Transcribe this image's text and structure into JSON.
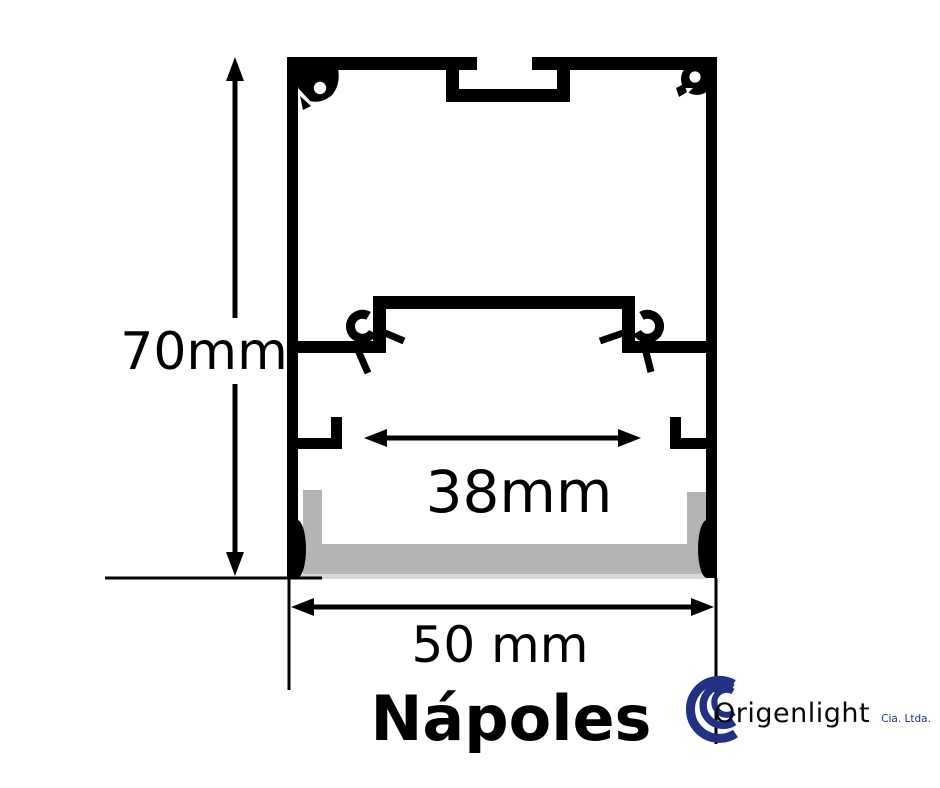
{
  "title": "Nápoles",
  "dimensions": {
    "height": "70mm",
    "inner_width": "38mm",
    "outer_width": "50 mm"
  },
  "logo": {
    "name": "Origenlight",
    "suffix": "Cia. Ltda."
  },
  "colors": {
    "outline": "#000000",
    "diffuser": "#b4b4b4",
    "diffuser_edge": "#d8d8d8",
    "logo_blue": "#223183",
    "logo_text": "#0a0a0a"
  }
}
